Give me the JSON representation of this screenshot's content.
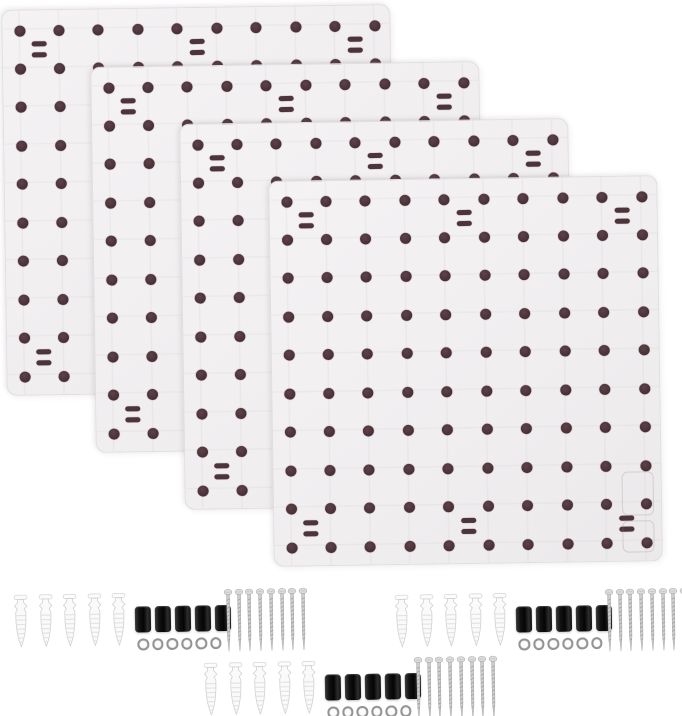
{
  "scene": {
    "width": 682,
    "height": 716,
    "background": "#ffffff",
    "description": "Product photo: four white perforated pegboard wall panels fanned in an overlapping diagonal stack, with three wall-mounting hardware sets (plastic anchors, black spacers, washers, screws) laid out below"
  },
  "panels": {
    "count": 4,
    "width": 389,
    "height": 386,
    "corner_radius": 10,
    "surface_color": "#f1eff0",
    "edge_color": "#e1dee0",
    "rotation_deg": -0.85,
    "positions": [
      {
        "x": 4,
        "y": 7
      },
      {
        "x": 93,
        "y": 64
      },
      {
        "x": 182,
        "y": 121
      },
      {
        "x": 271,
        "y": 178
      }
    ],
    "hole_grid": {
      "cols": 10,
      "rows": 10,
      "pad_x": 17,
      "pad_y": 20,
      "hole_diameter": 11,
      "hole_color": "#4a3138"
    },
    "slot_pairs": {
      "width": 15,
      "height": 4.5,
      "pair_gap": 11,
      "between_cols": [
        1,
        5,
        9
      ],
      "between_rows": [
        1,
        9
      ],
      "color": "#4d343b"
    }
  },
  "hardware_kits": {
    "count": 3,
    "rotation_deg": -1,
    "positions": [
      {
        "x": 14,
        "y": 589
      },
      {
        "x": 395,
        "y": 589
      },
      {
        "x": 204,
        "y": 657
      }
    ],
    "contents": {
      "wall_anchors": 5,
      "black_spacers": 5,
      "washers": 6,
      "screws": 8
    },
    "layout": {
      "anchor_offset_x": 0,
      "anchor_pitch": 24.5,
      "spacer_offset_x": 121,
      "spacer_pitch": 20,
      "washer_offset_x": 123,
      "washer_pitch": 14.5,
      "screw_offset_x": 210,
      "screw_pitch": 10.7
    },
    "colors": {
      "anchor_body": "#fafafa",
      "anchor_outline": "#d2d0d1",
      "spacer": "#111111",
      "washer_ring": "#949494",
      "screw_metal": "#cdcdcd"
    }
  }
}
